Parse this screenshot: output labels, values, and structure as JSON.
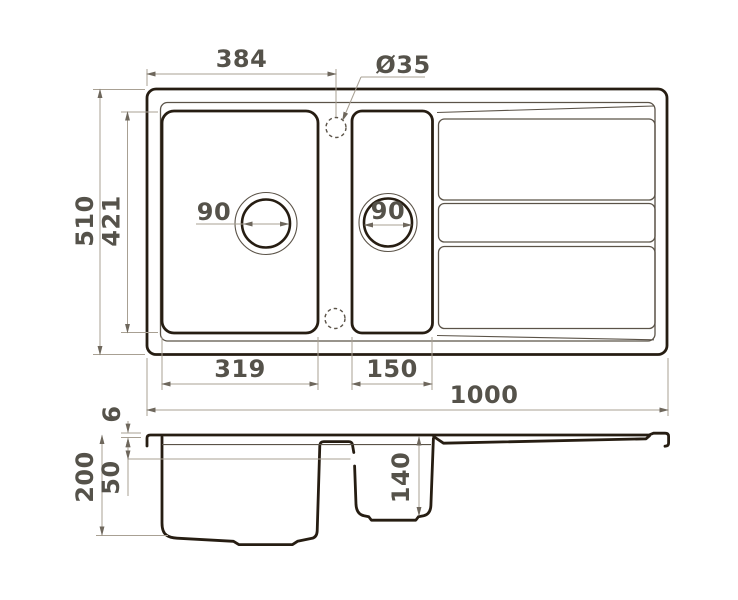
{
  "title": "Kitchen sink dimensional drawing",
  "colors": {
    "outline": "#261d12",
    "secondary": "#5b5348",
    "dimension": "#a8a093",
    "arrow": "#6e675c",
    "text": "#55524a",
    "background": "#ffffff"
  },
  "plan": {
    "dims": {
      "faucet_offset": "384",
      "faucet_hole": "Ø35",
      "overall_width": "510",
      "bowl_length": "421",
      "main_drain": "90",
      "half_drain": "90",
      "main_bowl_width": "319",
      "half_bowl_width": "150",
      "overall_length": "1000"
    }
  },
  "section": {
    "dims": {
      "rim_height": "6",
      "overall_depth": "200",
      "overflow_level": "50",
      "half_bowl_depth": "140"
    }
  }
}
